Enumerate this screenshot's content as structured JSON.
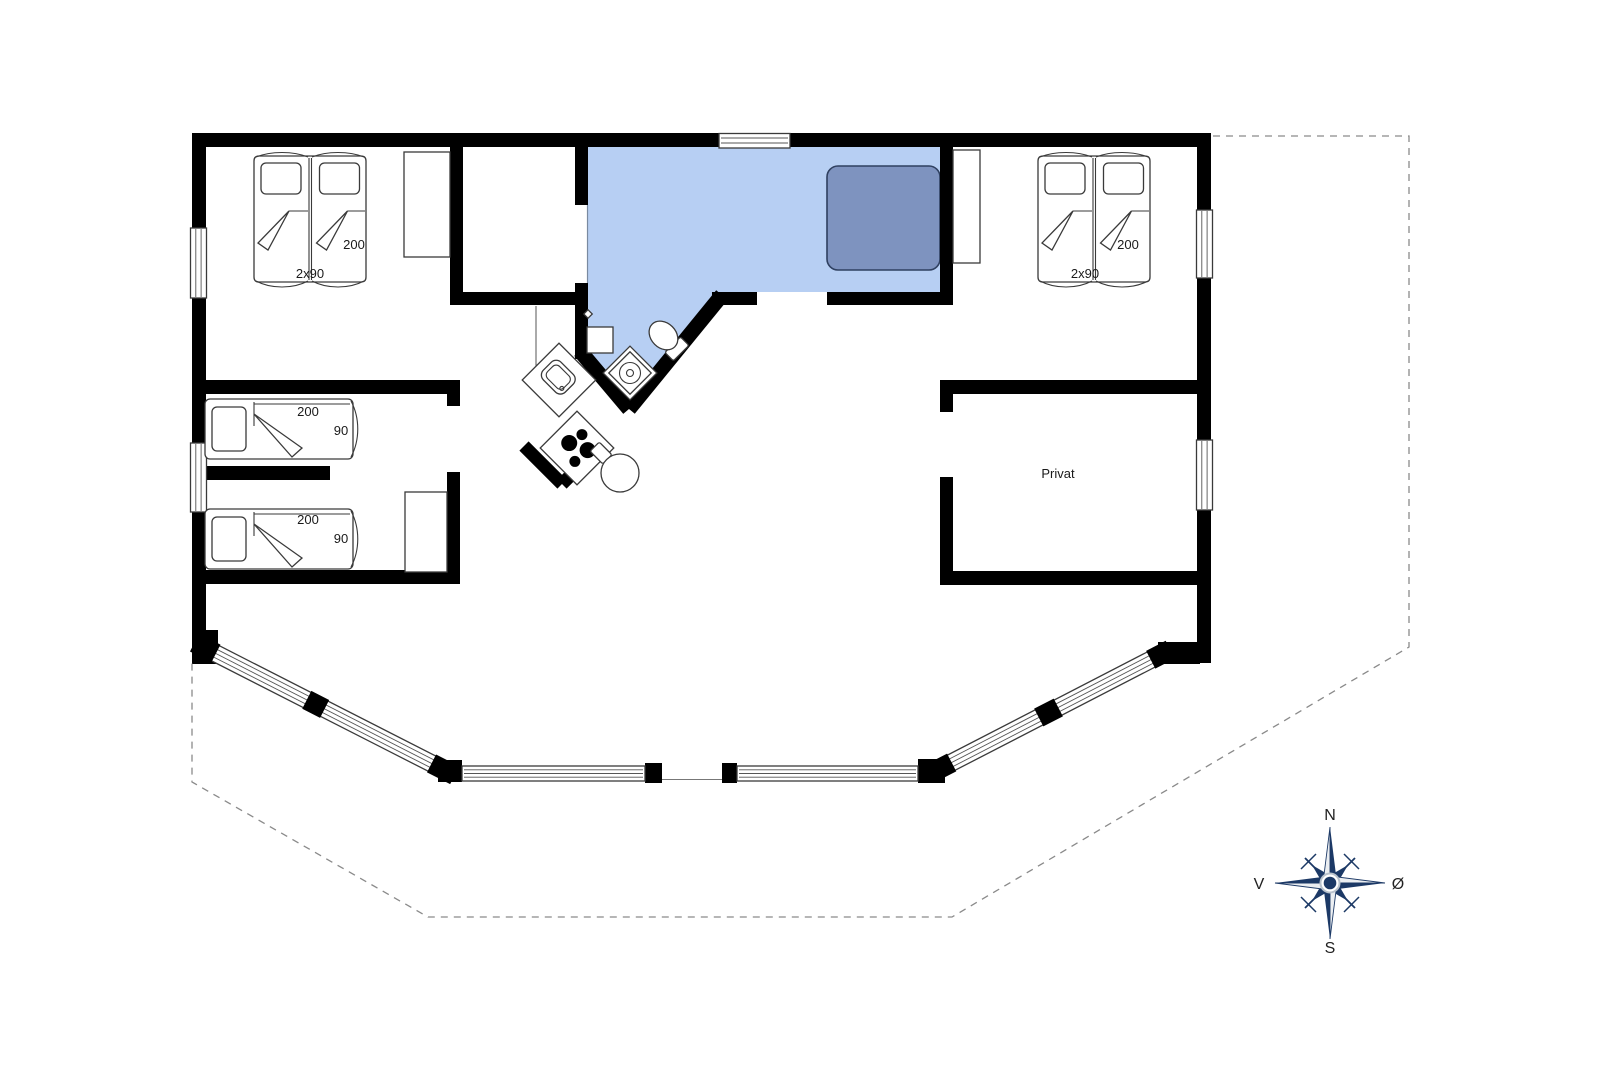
{
  "plan": {
    "colors": {
      "wall": "#000000",
      "bathroom_floor": "#b7cff3",
      "spa_fill": "#7e93bf",
      "spa_border": "#2f4060",
      "boundary_dash": "#8a8a8a",
      "compass_primary": "#1c3966",
      "compass_light": "#eceff2"
    },
    "labels": {
      "bed_double_left": {
        "length": "200",
        "width": "2x90"
      },
      "bed_double_right": {
        "length": "200",
        "width": "2x90"
      },
      "bed_single_upper": {
        "length": "200",
        "width": "90"
      },
      "bed_single_lower": {
        "length": "200",
        "width": "90"
      },
      "private_room": "Privat"
    },
    "compass": {
      "north": "N",
      "south": "S",
      "west": "V",
      "east": "Ø"
    }
  }
}
